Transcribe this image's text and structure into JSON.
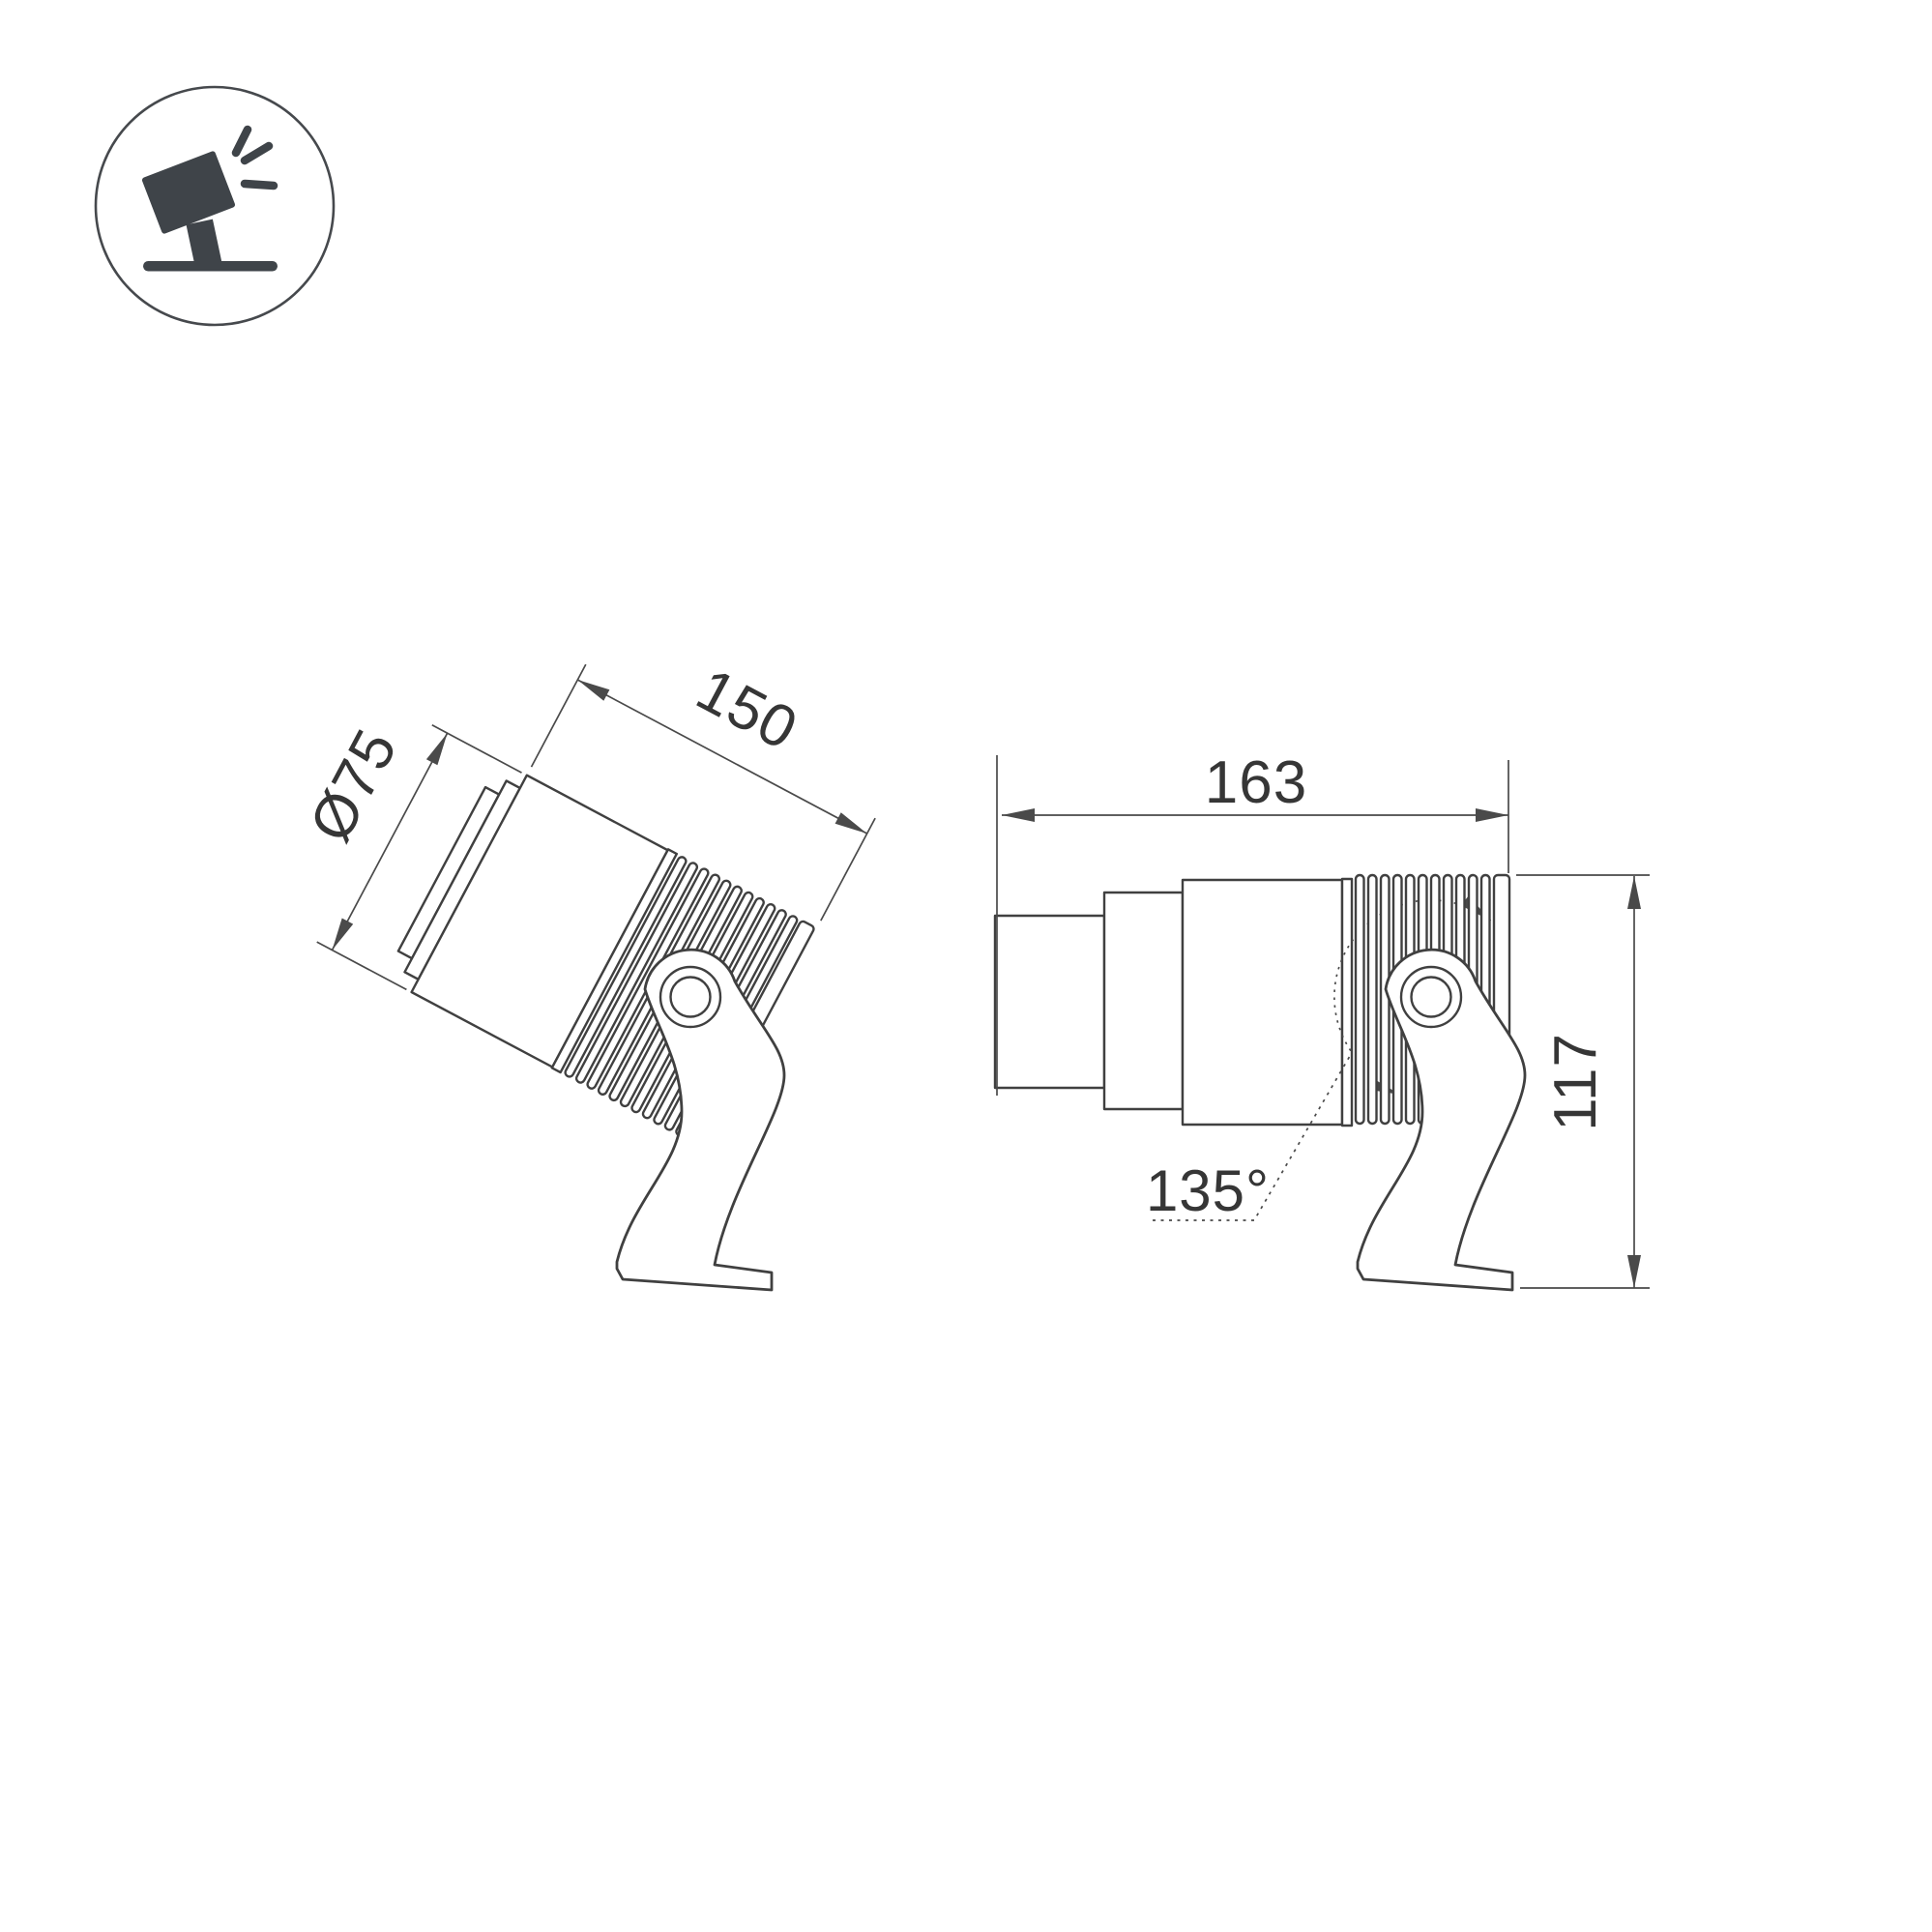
{
  "meta": {
    "background": "#ffffff",
    "line_color": "#404040",
    "dim_color": "#4a4a4a",
    "text_color": "#363636",
    "icon_color": "#3f4449",
    "icon_ring_color": "#46494d"
  },
  "icon": {
    "name": "tilted-spotlight-on-stand"
  },
  "views": {
    "left": {
      "description": "tilted spotlight side view",
      "diameter_label": "Ø75",
      "length_label": "150"
    },
    "right": {
      "description": "horizontal spotlight side view",
      "length_label": "163",
      "height_label": "117",
      "angle_label": "135°"
    }
  }
}
